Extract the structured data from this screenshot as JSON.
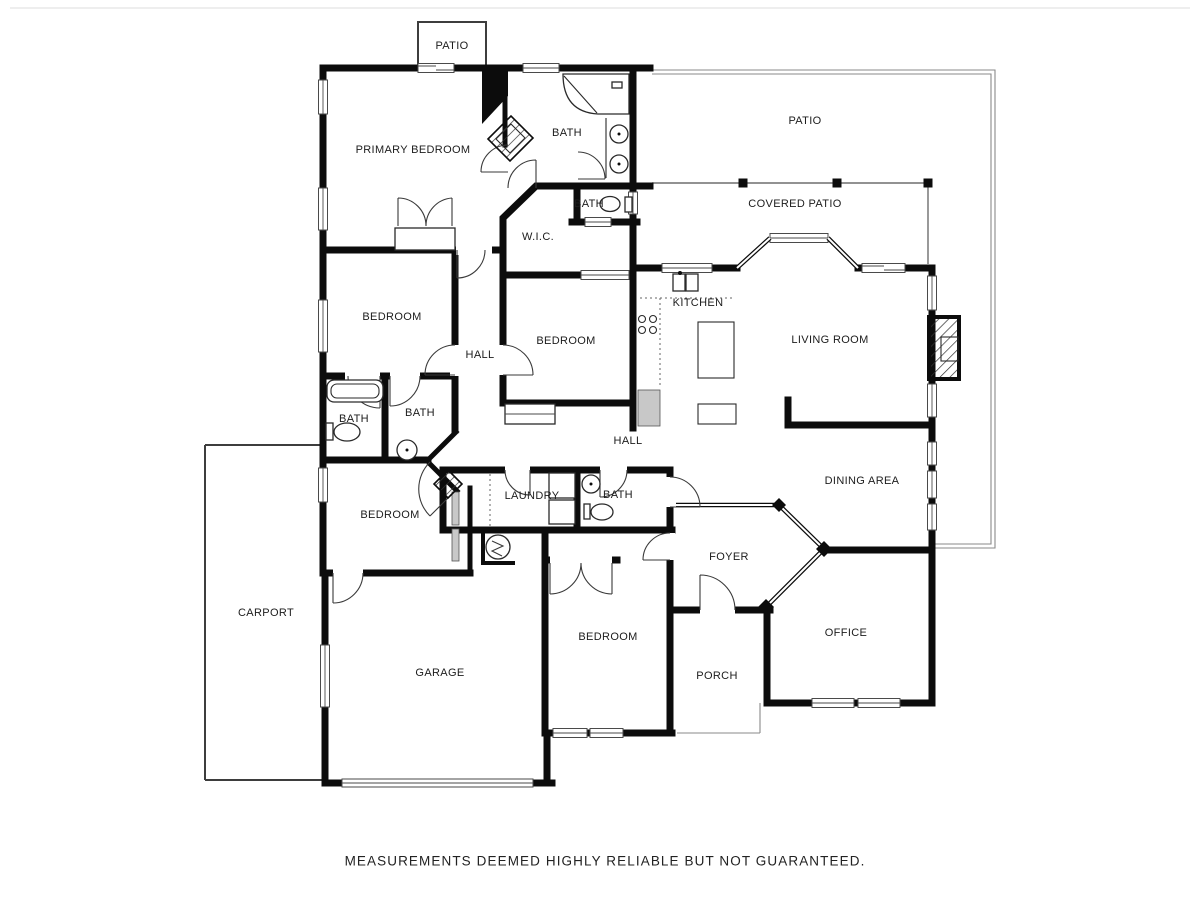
{
  "plan": {
    "rooms": [
      {
        "id": "patio-top",
        "label": "PATIO"
      },
      {
        "id": "primary-bedroom",
        "label": "PRIMARY BEDROOM"
      },
      {
        "id": "primary-bath",
        "label": "BATH"
      },
      {
        "id": "patio-right",
        "label": "PATIO"
      },
      {
        "id": "covered-patio",
        "label": "COVERED PATIO"
      },
      {
        "id": "toilet-bath",
        "label": "BATH"
      },
      {
        "id": "walk-in-closet",
        "label": "W.I.C."
      },
      {
        "id": "bedroom-left",
        "label": "BEDROOM"
      },
      {
        "id": "kitchen",
        "label": "KITCHEN"
      },
      {
        "id": "living-room",
        "label": "LIVING ROOM"
      },
      {
        "id": "bedroom-center",
        "label": "BEDROOM"
      },
      {
        "id": "hall-upper",
        "label": "HALL"
      },
      {
        "id": "bath-left",
        "label": "BATH"
      },
      {
        "id": "bath-middle",
        "label": "BATH"
      },
      {
        "id": "hall-lower",
        "label": "HALL"
      },
      {
        "id": "dining-area",
        "label": "DINING AREA"
      },
      {
        "id": "laundry",
        "label": "LAUNDRY"
      },
      {
        "id": "bath-lower",
        "label": "BATH"
      },
      {
        "id": "bedroom-lower-left",
        "label": "BEDROOM"
      },
      {
        "id": "foyer",
        "label": "FOYER"
      },
      {
        "id": "carport",
        "label": "CARPORT"
      },
      {
        "id": "office",
        "label": "OFFICE"
      },
      {
        "id": "bedroom-bottom",
        "label": "BEDROOM"
      },
      {
        "id": "garage",
        "label": "GARAGE"
      },
      {
        "id": "porch",
        "label": "PORCH"
      }
    ],
    "disclaimer": "MEASUREMENTS DEEMED HIGHLY RELIABLE BUT NOT GUARANTEED.",
    "colors": {
      "wall": "#0c0c0c",
      "thin_outline": "#8a8a8a",
      "background": "#ffffff"
    }
  }
}
